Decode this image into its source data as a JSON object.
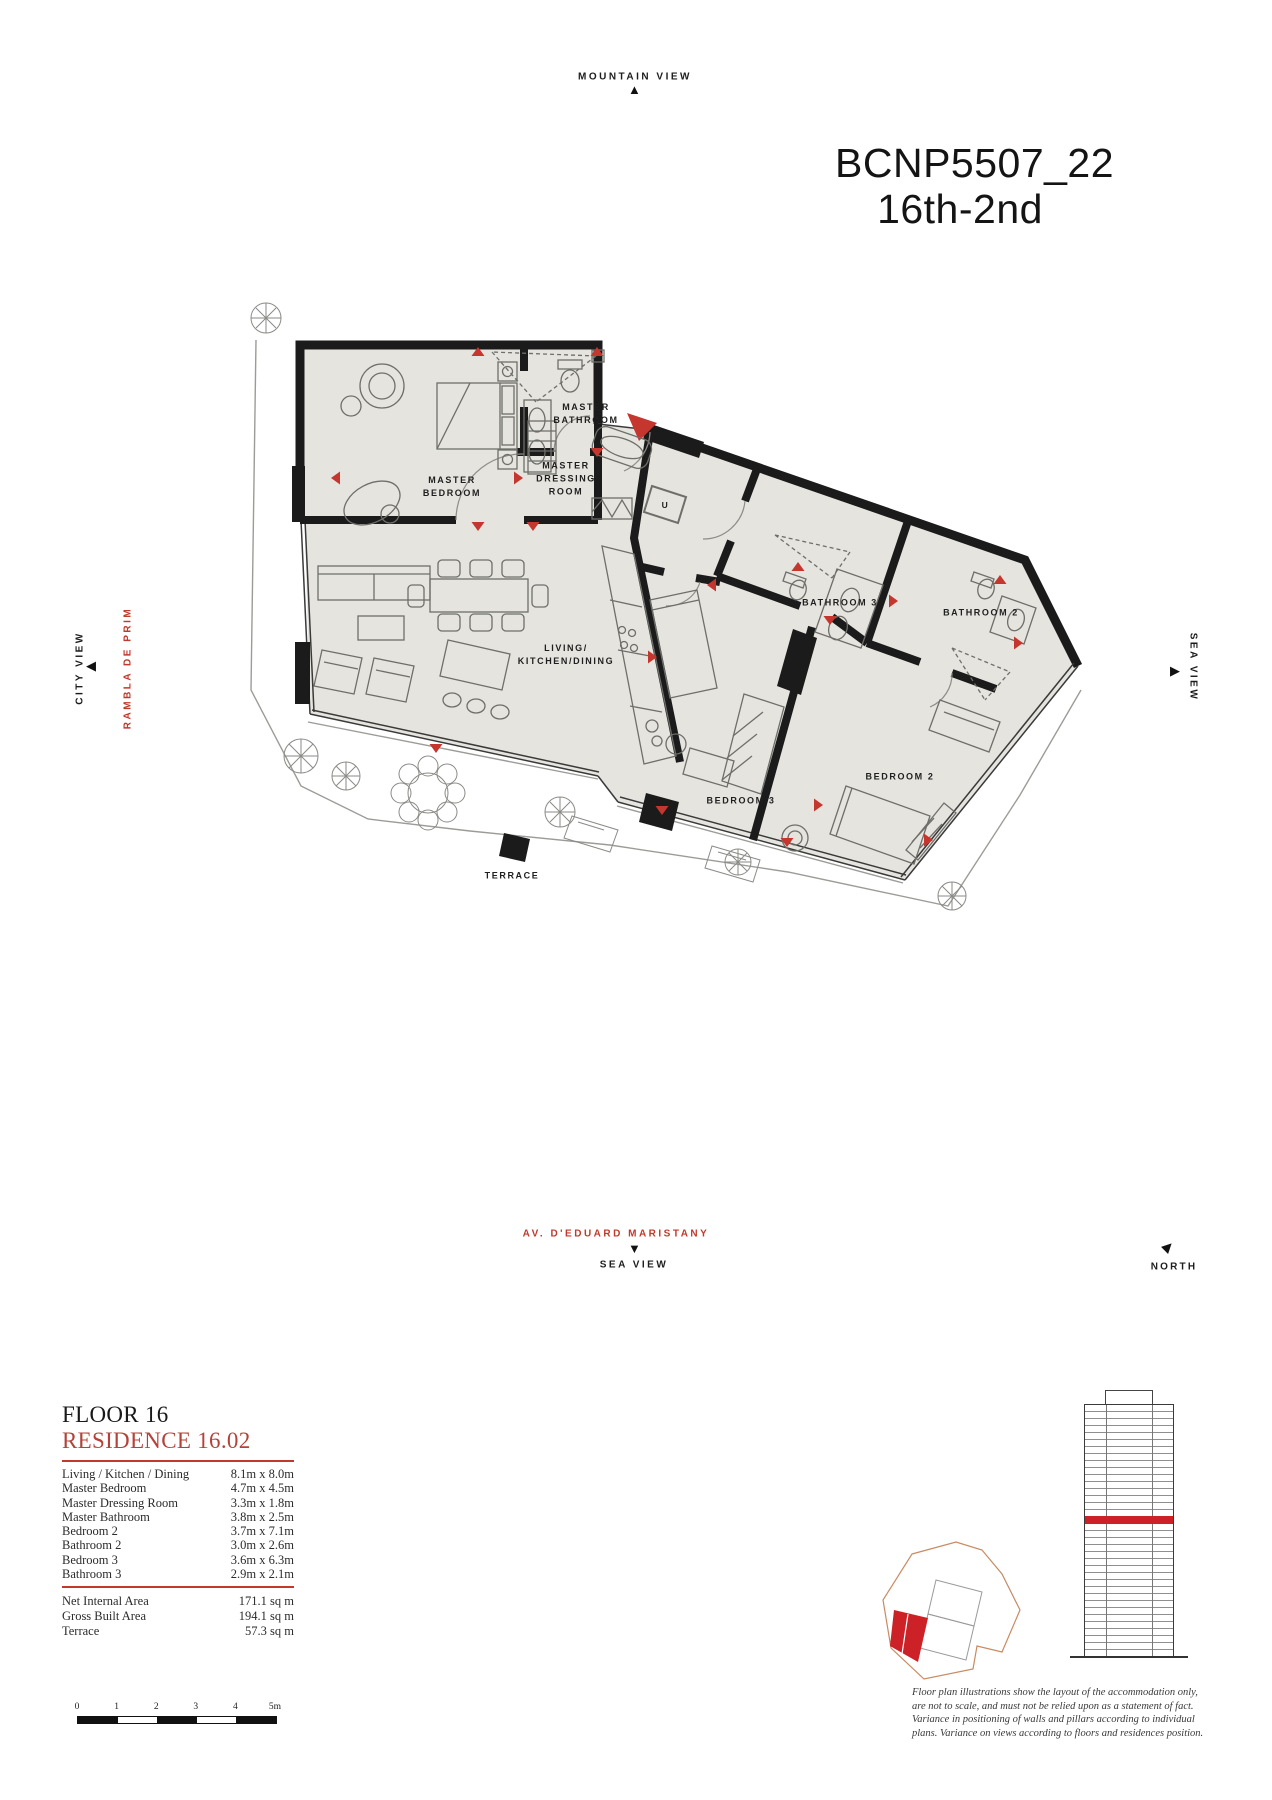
{
  "colors": {
    "accent_red": "#c0392b",
    "marker_red": "#c5372e",
    "unit_red": "#cc2127",
    "floor_fill": "#e6e4df",
    "wall_black": "#1b1b1b",
    "site_outline_tan": "#c98a62"
  },
  "header": {
    "title_line1": "BCNP5507_22",
    "title_line2": "16th-2nd"
  },
  "orientation": {
    "top_label": "MOUNTAIN VIEW",
    "left_view_label": "CITY VIEW",
    "left_street_label": "RAMBLA DE PRIM",
    "right_view_label": "SEA VIEW",
    "bottom_street_label": "AV. D'EDUARD MARISTANY",
    "bottom_view_label": "SEA VIEW",
    "north_label": "NORTH"
  },
  "plan": {
    "rooms": [
      {
        "label": "MASTER\nBEDROOM"
      },
      {
        "label": "MASTER\nBATHROOM"
      },
      {
        "label": "MASTER\nDRESSING\nROOM"
      },
      {
        "label": "LIVING/\nKITCHEN/DINING"
      },
      {
        "label": "BATHROOM 3"
      },
      {
        "label": "BATHROOM 2"
      },
      {
        "label": "BEDROOM 3"
      },
      {
        "label": "BEDROOM 2"
      },
      {
        "label": "TERRACE"
      },
      {
        "label": "U"
      }
    ]
  },
  "info_panel": {
    "floor_label": "FLOOR 16",
    "residence_label": "RESIDENCE 16.02",
    "dimensions": [
      {
        "name": "Living / Kitchen / Dining",
        "size": "8.1m x 8.0m"
      },
      {
        "name": "Master Bedroom",
        "size": "4.7m x 4.5m"
      },
      {
        "name": "Master Dressing Room",
        "size": "3.3m x 1.8m"
      },
      {
        "name": "Master Bathroom",
        "size": "3.8m x 2.5m"
      },
      {
        "name": "Bedroom 2",
        "size": "3.7m x 7.1m"
      },
      {
        "name": "Bathroom 2",
        "size": "3.0m x 2.6m"
      },
      {
        "name": "Bedroom 3",
        "size": "3.6m x 6.3m"
      },
      {
        "name": "Bathroom 3",
        "size": "2.9m x 2.1m"
      }
    ],
    "areas": [
      {
        "name": "Net Internal Area",
        "value": "171.1 sq m"
      },
      {
        "name": "Gross Built Area",
        "value": "194.1 sq m"
      },
      {
        "name": "Terrace",
        "value": "57.3 sq m"
      }
    ]
  },
  "scale_bar": {
    "tick_labels": [
      "0",
      "1",
      "2",
      "3",
      "4",
      "5m"
    ]
  },
  "disclaimer": "Floor plan illustrations show the layout of the accommodation only, are not to scale, and must not be relied upon as a statement of fact. Variance in positioning of walls and pillars according to individual plans. Variance on views according to floors and residences position."
}
